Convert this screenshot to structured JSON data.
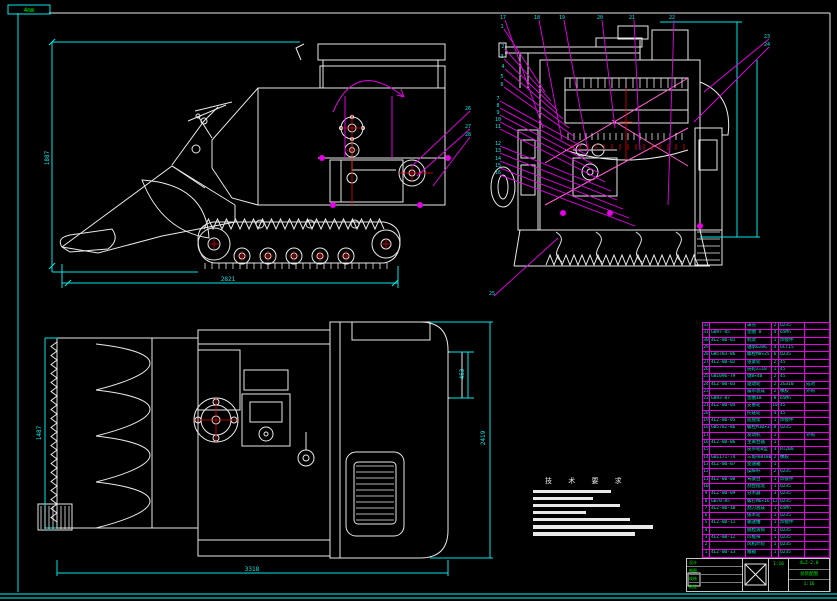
{
  "sheet": {
    "scale_label": "4mm"
  },
  "dims": {
    "side_height": "1887",
    "side_length": "2821",
    "top_width": "1487",
    "top_length": "3318",
    "top_depth": "2419",
    "top_offset": "453"
  },
  "notes": {
    "title": "技 术 要 求",
    "line_widths": [
      78,
      60,
      87,
      53,
      97,
      120,
      102
    ]
  },
  "balloons": [
    {
      "label": "17",
      "x": 503,
      "y": 19,
      "tx": 543,
      "ty": 128
    },
    {
      "label": "18",
      "x": 537,
      "y": 19,
      "tx": 562,
      "ty": 140
    },
    {
      "label": "19",
      "x": 562,
      "y": 19,
      "tx": 588,
      "ty": 152
    },
    {
      "label": "20",
      "x": 600,
      "y": 19,
      "tx": 615,
      "ty": 128
    },
    {
      "label": "21",
      "x": 632,
      "y": 19,
      "tx": 640,
      "ty": 150
    },
    {
      "label": "22",
      "x": 672,
      "y": 19,
      "tx": 668,
      "ty": 205
    },
    {
      "label": "23",
      "x": 767,
      "y": 38,
      "tx": 704,
      "ty": 92
    },
    {
      "label": "24",
      "x": 767,
      "y": 46,
      "tx": 694,
      "ty": 122
    },
    {
      "label": "1",
      "x": 502,
      "y": 28,
      "tx": 545,
      "ty": 92
    },
    {
      "label": "2",
      "x": 503,
      "y": 48,
      "tx": 551,
      "ty": 101
    },
    {
      "label": "3",
      "x": 502,
      "y": 58,
      "tx": 557,
      "ty": 110
    },
    {
      "label": "4",
      "x": 503,
      "y": 68,
      "tx": 563,
      "ty": 119
    },
    {
      "label": "5",
      "x": 502,
      "y": 78,
      "tx": 569,
      "ty": 128
    },
    {
      "label": "6",
      "x": 502,
      "y": 86,
      "tx": 575,
      "ty": 137
    },
    {
      "label": "7",
      "x": 498,
      "y": 100,
      "tx": 581,
      "ty": 146
    },
    {
      "label": "8",
      "x": 498,
      "y": 107,
      "tx": 587,
      "ty": 155
    },
    {
      "label": "9",
      "x": 498,
      "y": 114,
      "tx": 593,
      "ty": 164
    },
    {
      "label": "10",
      "x": 498,
      "y": 121,
      "tx": 599,
      "ty": 173
    },
    {
      "label": "11",
      "x": 498,
      "y": 128,
      "tx": 605,
      "ty": 182
    },
    {
      "label": "12",
      "x": 498,
      "y": 145,
      "tx": 611,
      "ty": 191
    },
    {
      "label": "13",
      "x": 498,
      "y": 152,
      "tx": 617,
      "ty": 200
    },
    {
      "label": "14",
      "x": 498,
      "y": 160,
      "tx": 623,
      "ty": 209
    },
    {
      "label": "15",
      "x": 498,
      "y": 167,
      "tx": 629,
      "ty": 218
    },
    {
      "label": "16",
      "x": 498,
      "y": 174,
      "tx": 635,
      "ty": 226
    },
    {
      "label": "25",
      "x": 492,
      "y": 295,
      "tx": 558,
      "ty": 238
    },
    {
      "label": "26",
      "x": 468,
      "y": 110,
      "tx": 412,
      "ty": 166
    },
    {
      "label": "27",
      "x": 468,
      "y": 128,
      "tx": 417,
      "ty": 176
    },
    {
      "label": "28",
      "x": 468,
      "y": 136,
      "tx": 433,
      "ty": 186
    }
  ],
  "bom": {
    "rows": [
      [
        "32",
        "",
        "罩壳",
        "2",
        "Q235",
        ""
      ],
      [
        "31",
        "GB97-85",
        "垫圈 8",
        "4",
        "65Mn",
        ""
      ],
      [
        "30",
        "4LZ-00-01",
        "机架",
        "1",
        "焊接件",
        ""
      ],
      [
        "29",
        "",
        "轴承6206",
        "4",
        "GCr15",
        ""
      ],
      [
        "28",
        "GB5783-86",
        "螺栓M8×25",
        "6",
        "Q235",
        ""
      ],
      [
        "27",
        "4LZ-00-02",
        "张紧轮",
        "2",
        "45",
        ""
      ],
      [
        "26",
        "",
        "链轮Z=18",
        "1",
        "45",
        ""
      ],
      [
        "25",
        "GB1096-79",
        "键8×40",
        "2",
        "45",
        ""
      ],
      [
        "24",
        "4LZ-00-03",
        "驱动轮",
        "2",
        "ZG310",
        "成对"
      ],
      [
        "23",
        "",
        "履带总成",
        "2",
        "橡胶",
        "外购"
      ],
      [
        "22",
        "GB93-87",
        "垫圈10",
        "8",
        "65Mn",
        ""
      ],
      [
        "21",
        "4LZ-00-04",
        "支重轮",
        "10",
        "45",
        ""
      ],
      [
        "20",
        "",
        "托链轮",
        "4",
        "45",
        ""
      ],
      [
        "19",
        "4LZ-00-05",
        "底盘架",
        "1",
        "焊接件",
        ""
      ],
      [
        "18",
        "GB5782-86",
        "螺栓M10×35",
        "8",
        "Q235",
        ""
      ],
      [
        "17",
        "",
        "发动机",
        "1",
        "",
        "外购"
      ],
      [
        "16",
        "4LZ-00-06",
        "主离合器",
        "1",
        "",
        ""
      ],
      [
        "15",
        "",
        "皮带轮B型",
        "3",
        "HT200",
        ""
      ],
      [
        "14",
        "GB1171-74",
        "三角带B1800",
        "2",
        "橡胶",
        ""
      ],
      [
        "13",
        "4LZ-00-07",
        "变速箱",
        "1",
        "",
        ""
      ],
      [
        "12",
        "",
        "操纵杆",
        "2",
        "Q235",
        ""
      ],
      [
        "11",
        "4LZ-00-08",
        "驾驶台",
        "1",
        "焊接件",
        ""
      ],
      [
        "10",
        "",
        "割台搅龙",
        "1",
        "Q235",
        ""
      ],
      [
        "9",
        "4LZ-00-09",
        "分禾器",
        "3",
        "Q235",
        ""
      ],
      [
        "8",
        "GB70-85",
        "螺钉M6×16",
        "12",
        "Q235",
        ""
      ],
      [
        "7",
        "4LZ-00-10",
        "割刀总成",
        "1",
        "65Mn",
        ""
      ],
      [
        "6",
        "",
        "拨禾轮",
        "1",
        "Q235",
        ""
      ],
      [
        "5",
        "4LZ-00-11",
        "输送槽",
        "1",
        "焊接件",
        ""
      ],
      [
        "4",
        "",
        "脱粒滚筒",
        "1",
        "Q235",
        ""
      ],
      [
        "3",
        "4LZ-00-12",
        "凹板筛",
        "1",
        "Q235",
        ""
      ],
      [
        "2",
        "",
        "风机叶轮",
        "1",
        "Q235",
        ""
      ],
      [
        "1",
        "4LZ-00-13",
        "粮箱",
        "1",
        "Q235",
        ""
      ]
    ]
  },
  "title_block": {
    "left_rows": [
      "设计",
      "制图",
      "校核",
      "批准"
    ],
    "scale": "1:16",
    "right_rows": [
      "4LZ-2.0",
      "总装配图",
      "1:16"
    ]
  },
  "colors": {
    "line": "#e9e9e9",
    "cyan": "#00e8e8",
    "magenta": "#e800e8",
    "pink": "#ff5fd0",
    "green": "#00e800",
    "red": "#e80000"
  }
}
